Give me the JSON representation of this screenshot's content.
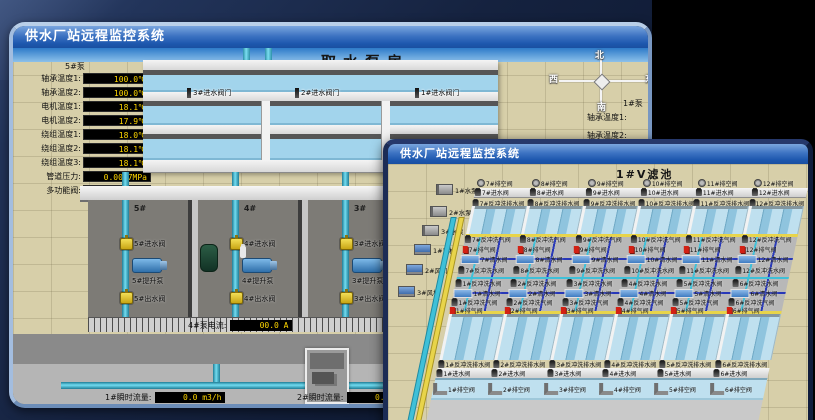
{
  "colors": {
    "titlebar_top": "#7aa6de",
    "titlebar_bottom": "#1a4fa0",
    "value_text": "#ffd700",
    "value_bg": "#000000",
    "alarm_red": "#d32114",
    "pipe_cyan": "#3fc0d8",
    "pipe_yellow": "#e8d44a",
    "pipe_blue": "#2838b8",
    "water": "#a2d4ec",
    "ground": "#d7cfa9"
  },
  "back_window": {
    "title": "供水厂站远程监控系统",
    "scene_title": "取水泵房",
    "pump_panel": {
      "header": "5#泵",
      "rows": [
        {
          "label": "轴承温度1:",
          "value": "100.0℃"
        },
        {
          "label": "轴承温度2:",
          "value": "100.0℃"
        },
        {
          "label": "电机温度1:",
          "value": "18.1℃"
        },
        {
          "label": "电机温度2:",
          "value": "17.9℃"
        },
        {
          "label": "绕组温度1:",
          "value": "18.0℃"
        },
        {
          "label": "绕组温度2:",
          "value": "18.1℃"
        },
        {
          "label": "绕组温度3:",
          "value": "18.1℃"
        },
        {
          "label": "管道压力:",
          "value": "0.0007MPa"
        },
        {
          "label": "多功能阀:",
          "value": "0%"
        }
      ]
    },
    "intake_valves": [
      "3#进水阀门",
      "2#进水阀门",
      "1#进水阀门"
    ],
    "compass": {
      "north": "北",
      "west": "西",
      "south": "南",
      "east": "东"
    },
    "right_panel": {
      "header": "1#泵",
      "labels": [
        "轴承温度1:",
        "轴承温度2:"
      ]
    },
    "pump_bays": [
      {
        "no": "5#",
        "inlet": "5#进水阀",
        "pump": "5#提升泵",
        "outlet": "5#出水阀"
      },
      {
        "no": "4#",
        "inlet": "4#进水阀",
        "pump": "4#提升泵",
        "outlet": "4#出水阀"
      },
      {
        "no": "3#",
        "inlet": "3#进水阀",
        "pump": "3#提升泵",
        "outlet": "3#出水阀"
      },
      {
        "no": "2#",
        "inlet": "2#进水阀",
        "pump": "2#提升泵",
        "outlet": "2#出水阀"
      },
      {
        "no": "1#",
        "inlet": "1#进水阀",
        "pump": "1#提升泵",
        "outlet": "1#出水阀"
      }
    ],
    "current_readings": [
      {
        "label": "4#泵电流:",
        "value": "00.0 A"
      },
      {
        "label": "2#泵电流:",
        "value": "00.0 A"
      }
    ],
    "flow_readings": [
      {
        "label": "1#瞬时流量:",
        "value": "0.0 m3/h"
      },
      {
        "label": "2#瞬时流量:",
        "value": "0.0 m3/h"
      }
    ]
  },
  "front_window": {
    "title": "供水厂站远程监控系统",
    "scene_title": "1#V滤池",
    "machines": [
      "1#水泵",
      "2#水泵",
      "3#水泵",
      "1#风机",
      "2#风机",
      "3#风机"
    ],
    "grid": {
      "top": {
        "vent": [
          "7#排空阀",
          "8#排空阀",
          "9#排空阀",
          "10#排空阀",
          "11#排空阀",
          "12#排空阀"
        ],
        "inlet": [
          "7#进水阀",
          "8#进水阀",
          "9#进水阀",
          "10#进水阀",
          "11#进水阀",
          "12#进水阀"
        ],
        "bwdrain": [
          "7#反冲洗排水阀",
          "8#反冲洗排水阀",
          "9#反冲洗排水阀",
          "10#反冲洗排水阀",
          "11#反冲洗排水阀",
          "12#反冲洗排水阀"
        ],
        "air": [
          "7#反冲洗气阀",
          "8#反冲洗气阀",
          "9#反冲洗气阀",
          "10#反冲洗气阀",
          "11#反冲洗气阀",
          "12#反冲洗气阀"
        ],
        "exhaust": [
          "7#排气阀",
          "8#排气阀",
          "9#排气阀",
          "10#排气阀",
          "11#排气阀",
          "12#排气阀"
        ],
        "clean": [
          "7#清水阀",
          "8#清水阀",
          "9#清水阀",
          "10#清水阀",
          "11#清水阀",
          "12#清水阀"
        ],
        "bwwater": [
          "7#反冲洗水阀",
          "8#反冲洗水阀",
          "9#反冲洗水阀",
          "10#反冲洗水阀",
          "11#反冲洗水阀",
          "12#反冲洗水阀"
        ]
      },
      "bottom": {
        "vent": [
          "1#排空阀",
          "2#排空阀",
          "3#排空阀",
          "4#排空阀",
          "5#排空阀",
          "6#排空阀"
        ],
        "inlet": [
          "1#进水阀",
          "2#进水阀",
          "3#进水阀",
          "4#进水阀",
          "5#进水阀",
          "6#进水阀"
        ],
        "bwdrain": [
          "1#反冲洗排水阀",
          "2#反冲洗排水阀",
          "3#反冲洗排水阀",
          "4#反冲洗排水阀",
          "5#反冲洗排水阀",
          "6#反冲洗排水阀"
        ],
        "air": [
          "1#反冲洗气阀",
          "2#反冲洗气阀",
          "3#反冲洗气阀",
          "4#反冲洗气阀",
          "5#反冲洗气阀",
          "6#反冲洗气阀"
        ],
        "exhaust": [
          "1#排气阀",
          "2#排气阀",
          "3#排气阀",
          "4#排气阀",
          "5#排气阀",
          "6#排气阀"
        ],
        "clean": [
          "1#清水阀",
          "2#清水阀",
          "3#清水阀",
          "4#清水阀",
          "5#清水阀",
          "6#清水阀"
        ],
        "bwwater": [
          "1#反冲洗水阀",
          "2#反冲洗水阀",
          "3#反冲洗水阀",
          "4#反冲洗水阀",
          "5#反冲洗水阀",
          "6#反冲洗水阀"
        ]
      }
    }
  }
}
